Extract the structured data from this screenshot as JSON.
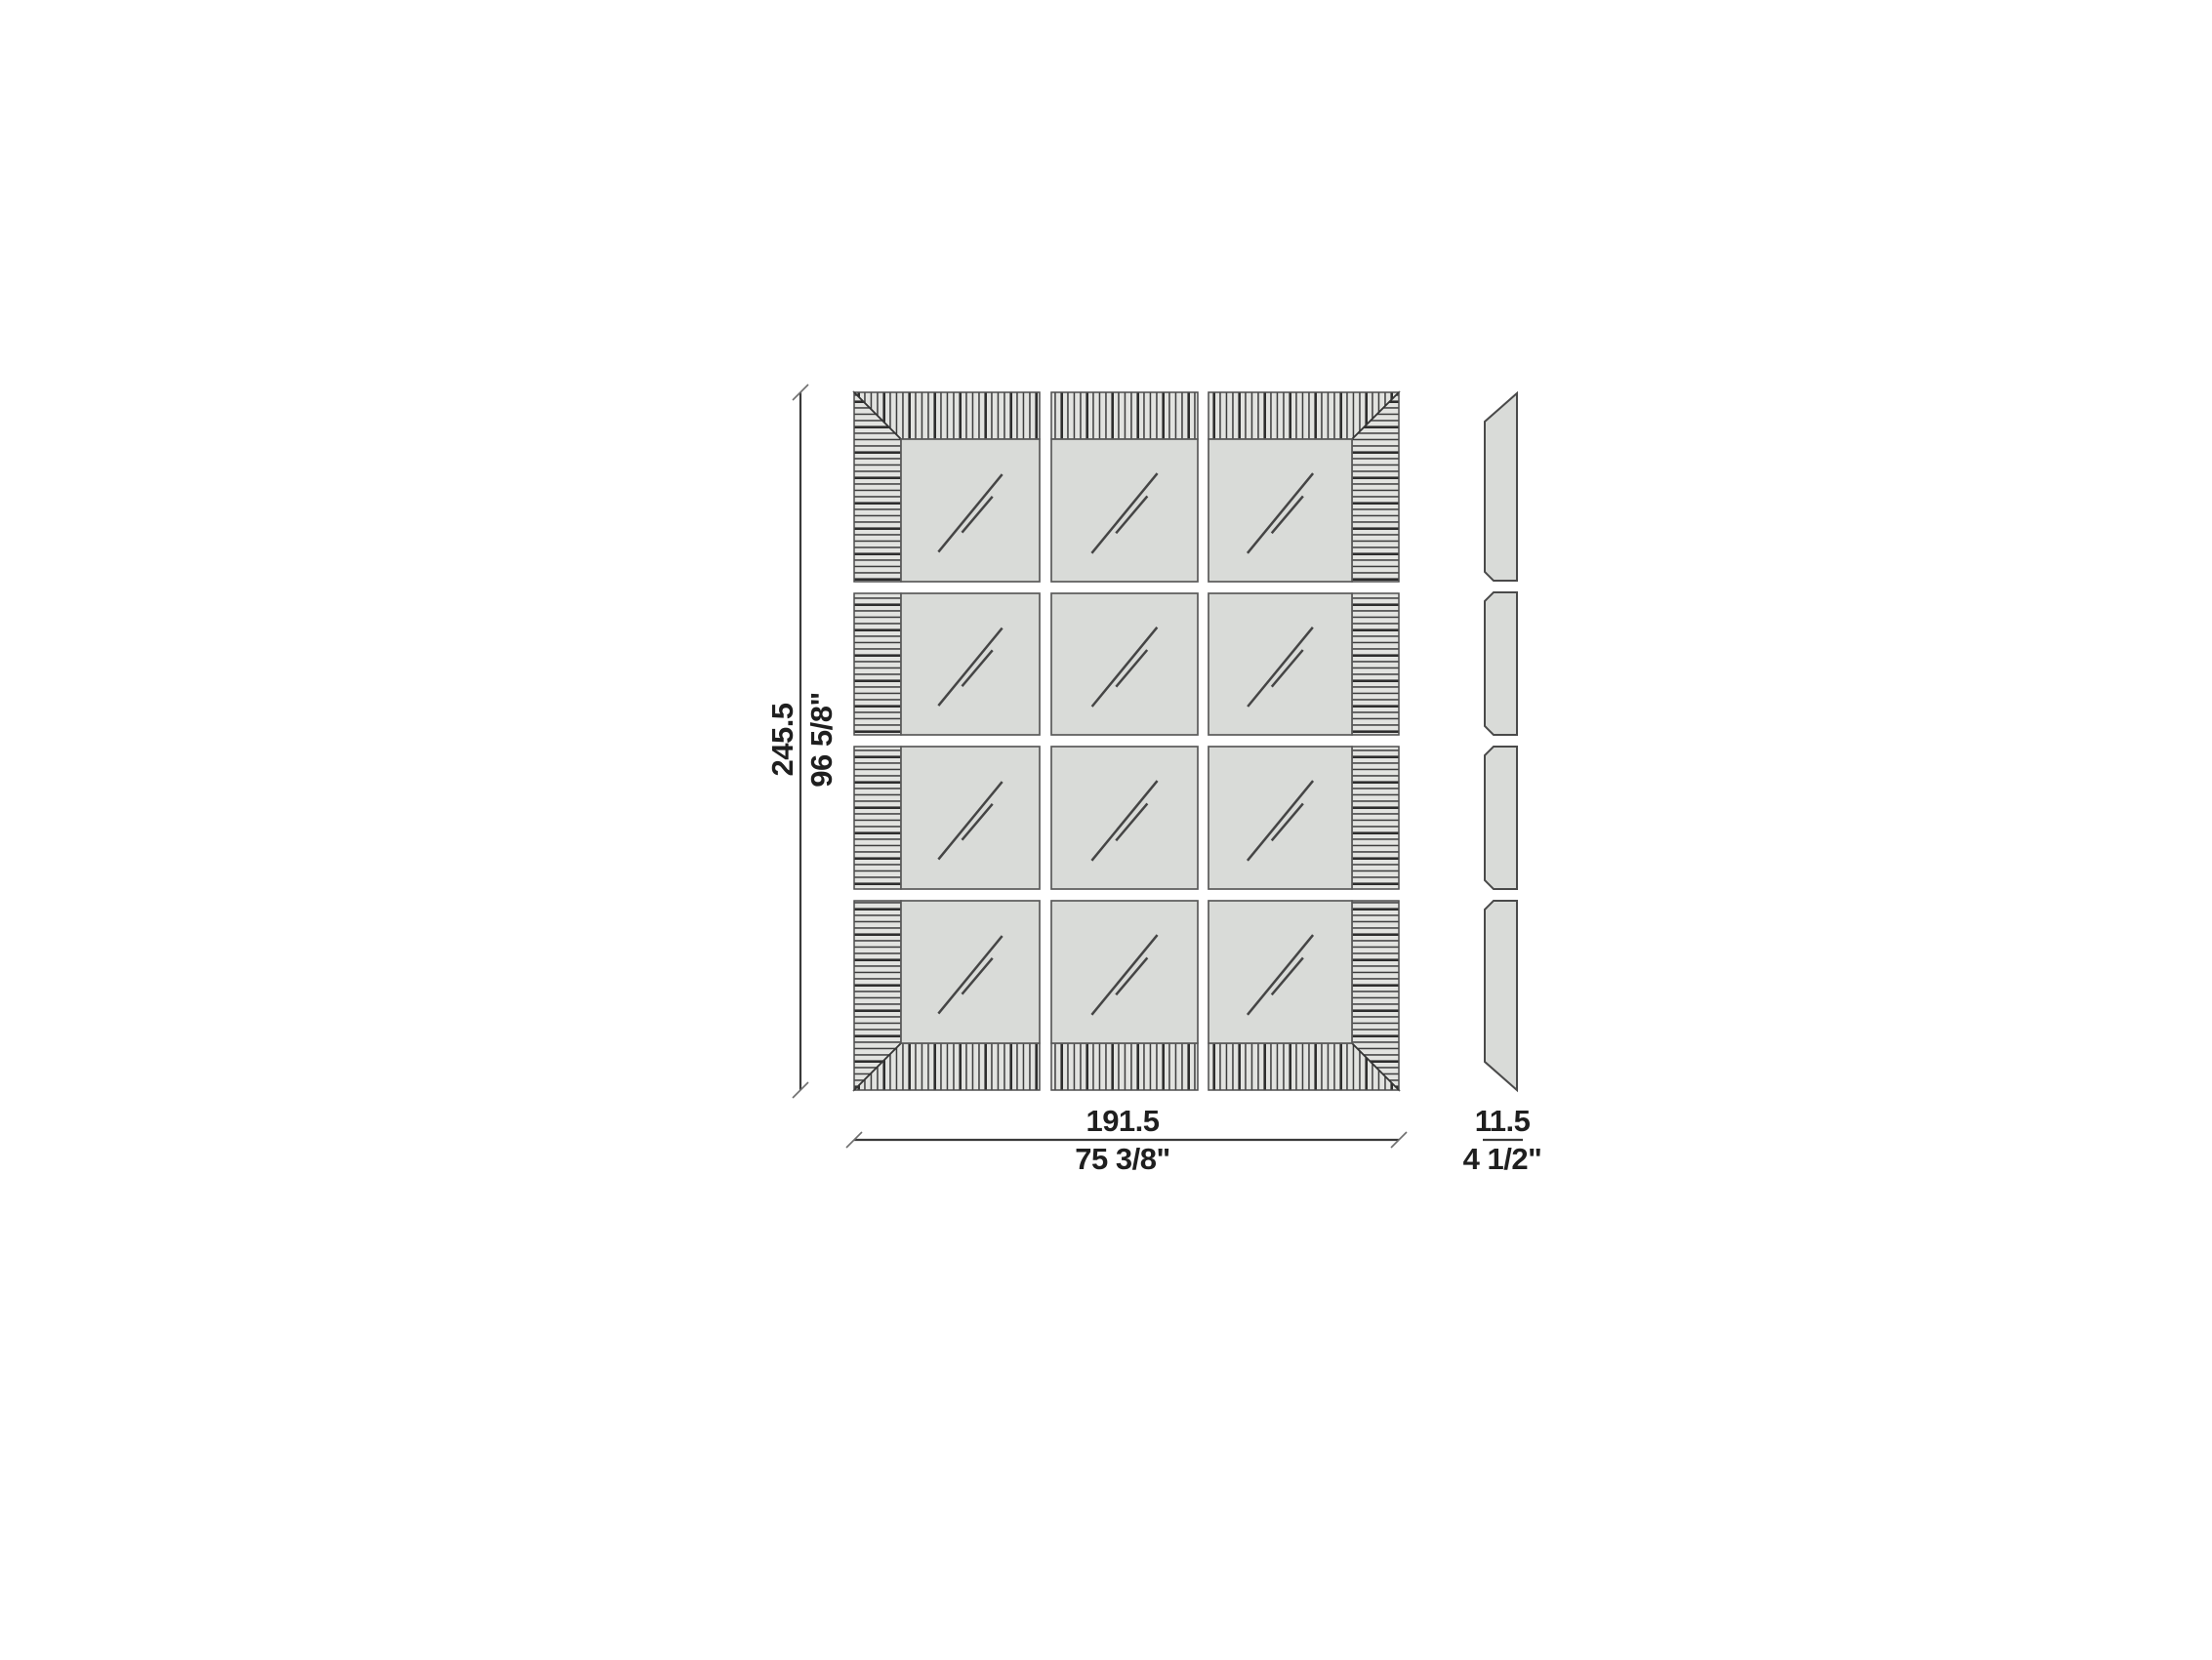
{
  "drawing": {
    "type": "furniture-dimension-diagram",
    "views": {
      "front": {
        "grid_columns": 3,
        "grid_rows": 4,
        "frame": "hatched-mitered-border",
        "panel_symbol": "mirror-reflection"
      },
      "side": {
        "segments": 4,
        "profile": "beveled-top-and-bottom"
      }
    },
    "dimensions": {
      "height": {
        "cm": "245.5",
        "inches": "96 5/8\""
      },
      "width": {
        "cm": "191.5",
        "inches": "75 3/8\""
      },
      "depth": {
        "cm": "11.5",
        "inches": "4 1/2\""
      }
    },
    "colors": {
      "background": "#ffffff",
      "panel_fill": "#d9dbd8",
      "hatch_fill": "#e2e3e0",
      "hatch_line": "#3d3d3d",
      "outline": "#4d4d4d",
      "text": "#1f1f1f"
    }
  }
}
